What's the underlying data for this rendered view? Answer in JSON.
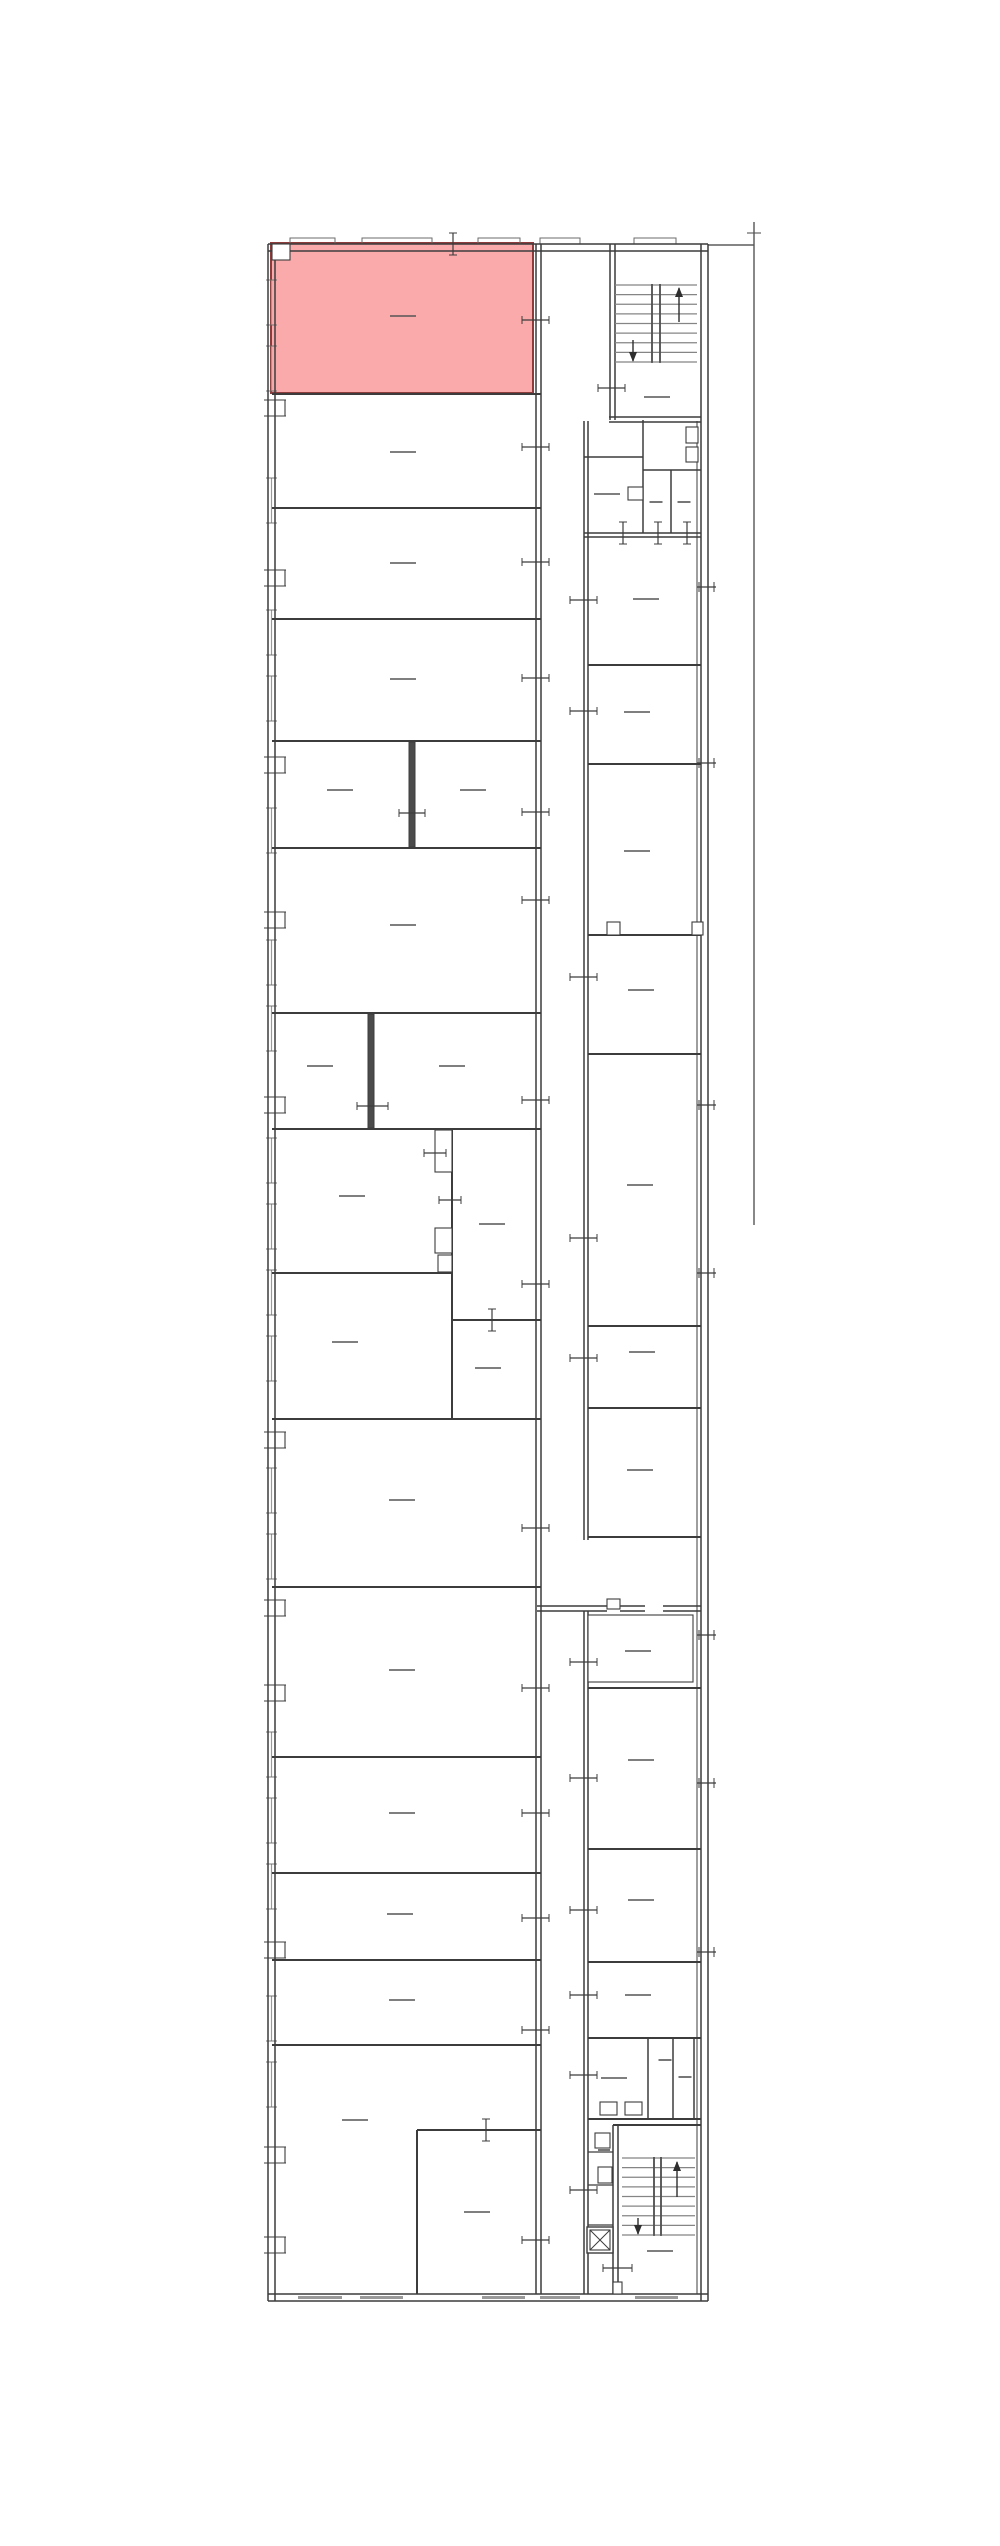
{
  "meta": {
    "type": "architectural-floor-plan",
    "canvas": {
      "width": 1000,
      "height": 2546
    },
    "colors": {
      "background": "#ffffff",
      "wall": "#3c3c3c",
      "wall_light": "#6b6b6b",
      "thick_wall_fill": "#4b4b4b",
      "window": "#999999",
      "label": "#555555",
      "tread": "#858585",
      "arrow": "#2e2e2e",
      "highlight_fill": "#faaaaa",
      "highlight_stroke": "#8e3b3b",
      "ref_line": "#555555"
    }
  },
  "plan": {
    "highlight_room": {
      "x": 271,
      "y": 243,
      "w": 262,
      "h": 150
    },
    "h_walls": [
      [
        244,
        268,
        708,
        1.5
      ],
      [
        251,
        268,
        708,
        1.5
      ],
      [
        2294,
        268,
        708,
        1.5
      ],
      [
        2301,
        268,
        708,
        1.5
      ],
      [
        394,
        272,
        541,
        2
      ],
      [
        508,
        272,
        541,
        2
      ],
      [
        619,
        272,
        541,
        2
      ],
      [
        741,
        272,
        541,
        2
      ],
      [
        848,
        272,
        541,
        2
      ],
      [
        1013,
        272,
        541,
        2
      ],
      [
        1129,
        272,
        541,
        2
      ],
      [
        1273,
        272,
        452,
        2
      ],
      [
        1320,
        452,
        541,
        2
      ],
      [
        1419,
        272,
        541,
        2
      ],
      [
        1587,
        272,
        541,
        2
      ],
      [
        1757,
        272,
        541,
        2
      ],
      [
        1873,
        272,
        541,
        2
      ],
      [
        1960,
        272,
        541,
        2
      ],
      [
        2045,
        272,
        541,
        2
      ],
      [
        2130,
        417,
        541,
        2
      ],
      [
        417,
        609,
        701,
        1.5
      ],
      [
        422,
        609,
        701,
        1.5
      ],
      [
        457,
        584,
        643,
        1.5
      ],
      [
        470,
        643,
        701,
        1.5
      ],
      [
        533,
        584,
        701,
        1.5
      ],
      [
        537,
        584,
        701,
        1.5
      ],
      [
        665,
        588,
        701,
        2
      ],
      [
        764,
        588,
        701,
        2
      ],
      [
        935,
        588,
        701,
        2
      ],
      [
        1054,
        588,
        701,
        2
      ],
      [
        1326,
        588,
        701,
        2
      ],
      [
        1408,
        588,
        701,
        2
      ],
      [
        1537,
        588,
        701,
        2
      ],
      [
        1606,
        537,
        607,
        1.5
      ],
      [
        1606,
        620,
        645,
        1.5
      ],
      [
        1606,
        663,
        701,
        1.5
      ],
      [
        1611,
        537,
        607,
        1.5
      ],
      [
        1611,
        620,
        645,
        1.5
      ],
      [
        1611,
        663,
        701,
        1.5
      ],
      [
        1688,
        588,
        701,
        2
      ],
      [
        1849,
        588,
        701,
        2
      ],
      [
        1962,
        588,
        701,
        2
      ],
      [
        2038,
        588,
        701,
        2
      ],
      [
        2119,
        588,
        701,
        2
      ],
      [
        2125,
        613,
        701,
        2
      ],
      [
        2152,
        588,
        613,
        1.2
      ],
      [
        2185,
        588,
        613,
        1.2
      ],
      [
        2225,
        588,
        613,
        1.2
      ],
      [
        245,
        708,
        754,
        1.2
      ]
    ],
    "v_walls": [
      [
        268,
        244,
        2301,
        1.5
      ],
      [
        275,
        244,
        2301,
        1.5
      ],
      [
        701,
        244,
        2301,
        1.5
      ],
      [
        708,
        244,
        2301,
        1.5
      ],
      [
        697,
        421,
        2294,
        1
      ],
      [
        536,
        244,
        2294,
        1.5
      ],
      [
        541,
        244,
        2294,
        1.5
      ],
      [
        584,
        421,
        1540,
        1.5
      ],
      [
        588,
        421,
        1540,
        1.5
      ],
      [
        584,
        1611,
        2294,
        1.5
      ],
      [
        588,
        1611,
        2294,
        1.5
      ],
      [
        610,
        244,
        420,
        1.5
      ],
      [
        615,
        244,
        420,
        1.5
      ],
      [
        643,
        420,
        533,
        1.5
      ],
      [
        671,
        470,
        533,
        1.5
      ],
      [
        452,
        1129,
        1419,
        2
      ],
      [
        417,
        2130,
        2294,
        2
      ],
      [
        648,
        2038,
        2119,
        1.5
      ],
      [
        673,
        2038,
        2119,
        1.5
      ],
      [
        694,
        2038,
        2119,
        1.5
      ],
      [
        613,
        2125,
        2294,
        1.5
      ],
      [
        618,
        2125,
        2294,
        1.5
      ],
      [
        652,
        284,
        362,
        1.5
      ],
      [
        660,
        284,
        362,
        1.5
      ],
      [
        654,
        2157,
        2235,
        1.5
      ],
      [
        661,
        2157,
        2235,
        1.5
      ]
    ],
    "thick_walls": [
      [
        409,
        742,
        6,
        105
      ],
      [
        368,
        1014,
        6,
        114
      ]
    ],
    "outline_rects": [
      [
        435,
        1130,
        17,
        42
      ],
      [
        435,
        1228,
        17,
        25
      ],
      [
        438,
        1255,
        14,
        17
      ],
      [
        588,
        1615,
        105,
        67
      ],
      [
        272,
        244,
        18,
        16
      ],
      [
        607,
        922,
        13,
        13
      ],
      [
        692,
        922,
        11,
        13
      ],
      [
        607,
        1599,
        13,
        10
      ],
      [
        613,
        2282,
        9,
        12
      ],
      [
        686,
        427,
        12,
        16
      ],
      [
        686,
        447,
        12,
        15
      ],
      [
        628,
        487,
        15,
        13
      ],
      [
        595,
        2133,
        15,
        15
      ],
      [
        598,
        2167,
        14,
        16
      ],
      [
        600,
        2102,
        17,
        13
      ],
      [
        625,
        2102,
        17,
        13
      ]
    ],
    "elevator": {
      "outer": [
        587,
        2227,
        26,
        26
      ],
      "inner": [
        590,
        2230,
        20,
        20
      ]
    },
    "stairs": [
      {
        "x1": 615,
        "x2": 697,
        "y1": 285,
        "y2": 362,
        "n": 9,
        "div": [
          652,
          660
        ],
        "up": {
          "x": 679,
          "y1": 288,
          "y2": 322
        },
        "down": {
          "x": 633,
          "y1": 340,
          "y2": 361
        }
      },
      {
        "x1": 622,
        "x2": 695,
        "y1": 2158,
        "y2": 2235,
        "n": 9,
        "div": [
          654,
          661
        ],
        "up": {
          "x": 677,
          "y1": 2162,
          "y2": 2197
        },
        "down": {
          "x": 638,
          "y1": 2218,
          "y2": 2234
        }
      }
    ],
    "door_ticks_h": [
      [
        522,
        549,
        320
      ],
      [
        522,
        549,
        447
      ],
      [
        522,
        549,
        562
      ],
      [
        522,
        549,
        678
      ],
      [
        522,
        549,
        812
      ],
      [
        522,
        549,
        900
      ],
      [
        522,
        549,
        1100
      ],
      [
        522,
        549,
        1284
      ],
      [
        522,
        549,
        1528
      ],
      [
        522,
        549,
        1688
      ],
      [
        522,
        549,
        1813
      ],
      [
        522,
        549,
        1918
      ],
      [
        522,
        549,
        2030
      ],
      [
        522,
        549,
        2240
      ],
      [
        570,
        597,
        600
      ],
      [
        570,
        597,
        711
      ],
      [
        570,
        597,
        977
      ],
      [
        570,
        597,
        1238
      ],
      [
        570,
        597,
        1358
      ],
      [
        570,
        597,
        1662
      ],
      [
        570,
        597,
        1778
      ],
      [
        570,
        597,
        1910
      ],
      [
        570,
        597,
        1995
      ],
      [
        570,
        597,
        2075
      ],
      [
        570,
        597,
        2190
      ],
      [
        439,
        461,
        1200
      ],
      [
        424,
        446,
        1153
      ],
      [
        598,
        625,
        388
      ],
      [
        603,
        632,
        2268
      ],
      [
        399,
        425,
        813
      ],
      [
        357,
        388,
        1106
      ]
    ],
    "door_ticks_v": [
      [
        492,
        1309,
        1331
      ],
      [
        486,
        2119,
        2141
      ],
      [
        453,
        233,
        255
      ],
      [
        623,
        522,
        544
      ],
      [
        658,
        522,
        544
      ],
      [
        687,
        522,
        544
      ]
    ],
    "right_wall_ticks": [
      587,
      763,
      1105,
      1273,
      1635,
      1783,
      1952
    ],
    "left_wall_doors": [
      408,
      578,
      765,
      920,
      1105,
      1440,
      1608,
      1693,
      1950,
      2155,
      2245
    ],
    "windows_left": {
      "x": 271.5,
      "start": 280,
      "end": 2282,
      "len": 45,
      "gap": 21,
      "tick_x1": 266,
      "tick_x2": 277
    },
    "windows_top": {
      "y": 238,
      "h": 6,
      "segments": [
        [
          290,
          335
        ],
        [
          362,
          432
        ],
        [
          478,
          520
        ],
        [
          540,
          580
        ],
        [
          634,
          676
        ]
      ]
    },
    "windows_bottom": {
      "y": 2297.5,
      "segments": [
        [
          298,
          342
        ],
        [
          360,
          403
        ],
        [
          482,
          525
        ],
        [
          540,
          580
        ],
        [
          635,
          678
        ]
      ]
    },
    "labels": [
      [
        403,
        316
      ],
      [
        403,
        452
      ],
      [
        403,
        563
      ],
      [
        403,
        679
      ],
      [
        340,
        790
      ],
      [
        473,
        790
      ],
      [
        403,
        925
      ],
      [
        320,
        1066
      ],
      [
        452,
        1066
      ],
      [
        352,
        1196
      ],
      [
        492,
        1224
      ],
      [
        345,
        1342
      ],
      [
        488,
        1368
      ],
      [
        402,
        1500
      ],
      [
        402,
        1670
      ],
      [
        402,
        1813
      ],
      [
        400,
        1914
      ],
      [
        402,
        2000
      ],
      [
        355,
        2120
      ],
      [
        477,
        2212
      ],
      [
        646,
        599
      ],
      [
        637,
        712
      ],
      [
        637,
        851
      ],
      [
        641,
        990
      ],
      [
        640,
        1185
      ],
      [
        642,
        1352
      ],
      [
        640,
        1470
      ],
      [
        638,
        1651
      ],
      [
        641,
        1760
      ],
      [
        641,
        1900
      ],
      [
        638,
        1995
      ],
      [
        607,
        494
      ],
      [
        614,
        2078
      ],
      [
        657,
        397
      ],
      [
        660,
        2251
      ],
      [
        656,
        502,
        13
      ],
      [
        684,
        502,
        13
      ],
      [
        665,
        2060,
        13
      ],
      [
        685,
        2077,
        13
      ],
      [
        604,
        2150,
        12
      ]
    ],
    "ref_line": {
      "x": 754,
      "y1": 222,
      "y2": 1225,
      "tick": [
        747,
        761,
        233
      ]
    }
  }
}
